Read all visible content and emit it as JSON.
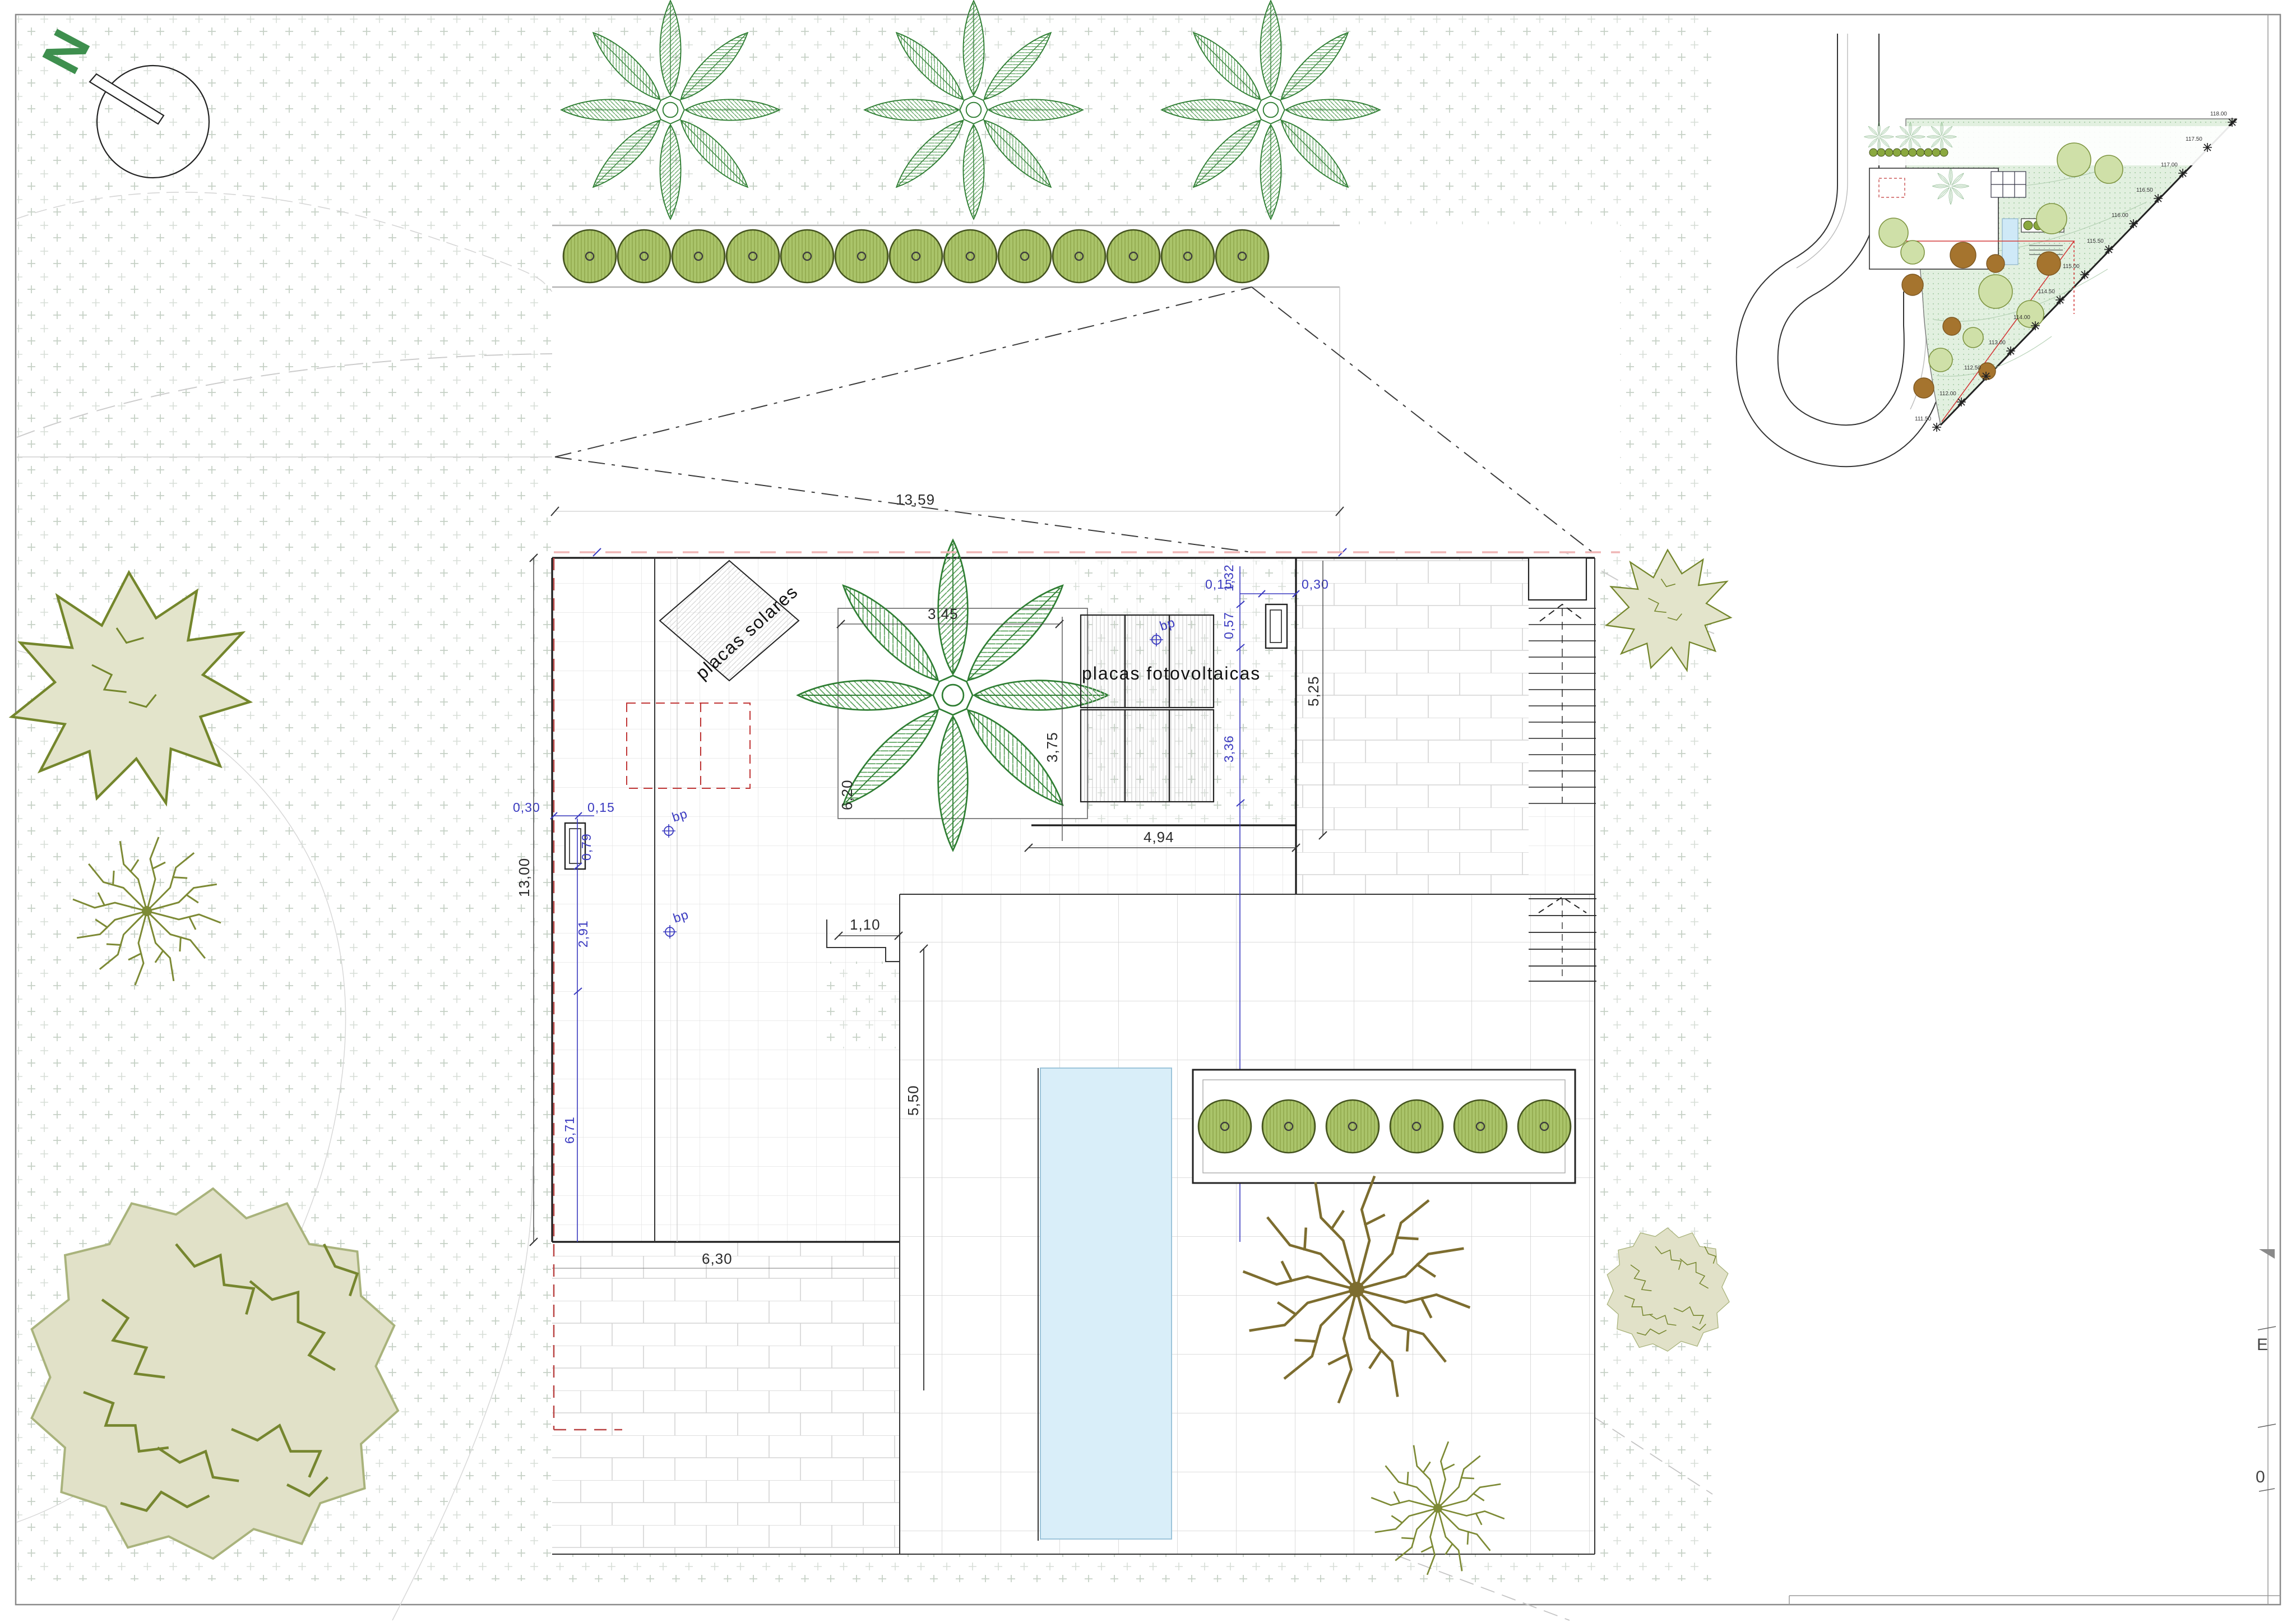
{
  "sheet": {
    "north_label": "N"
  },
  "labels": {
    "solar_panels": "placas solares",
    "pv_panels": "placas fotovoltaicas",
    "bench_mark": "bp"
  },
  "dims": {
    "site_width": "13,59",
    "left_total": "13,00",
    "left_offset_a": "0,30",
    "left_offset_b": "0,15",
    "left_chimney": "0,79",
    "left_seg_a": "2,91",
    "left_seg_b": "6,71",
    "courtyard_w": "3,45",
    "courtyard_h": "3,75",
    "courtyard_side": "6,20",
    "pv_gap": "0,57",
    "pv_height": "3,36",
    "right_offset_top": "1,32",
    "right_offset_a": "0,15",
    "right_offset_b": "0,30",
    "right_strip": "5,25",
    "terrace_w": "4,94",
    "step_w": "1,10",
    "terrace_h": "5,50",
    "garage_w": "6,30"
  },
  "edge": {
    "letter_e": "E",
    "digit_zero": "0"
  },
  "inset": {
    "elevations": [
      "111.50",
      "112.00",
      "112.50",
      "113.00",
      "114.00",
      "114.50",
      "115.00",
      "115.50",
      "116.00",
      "116.50",
      "117.00",
      "117.50",
      "118.00"
    ]
  },
  "colors": {
    "palm_green": "#2e7d32",
    "hedge_green": "#aac46a",
    "blob_fill": "#e1e1c8",
    "pool_blue": "#d9eef9",
    "red_dash": "#c03636",
    "pink_dash": "#efb6b6",
    "blue_dim": "#3a3ac0",
    "stipple": "#c6d1c6"
  }
}
